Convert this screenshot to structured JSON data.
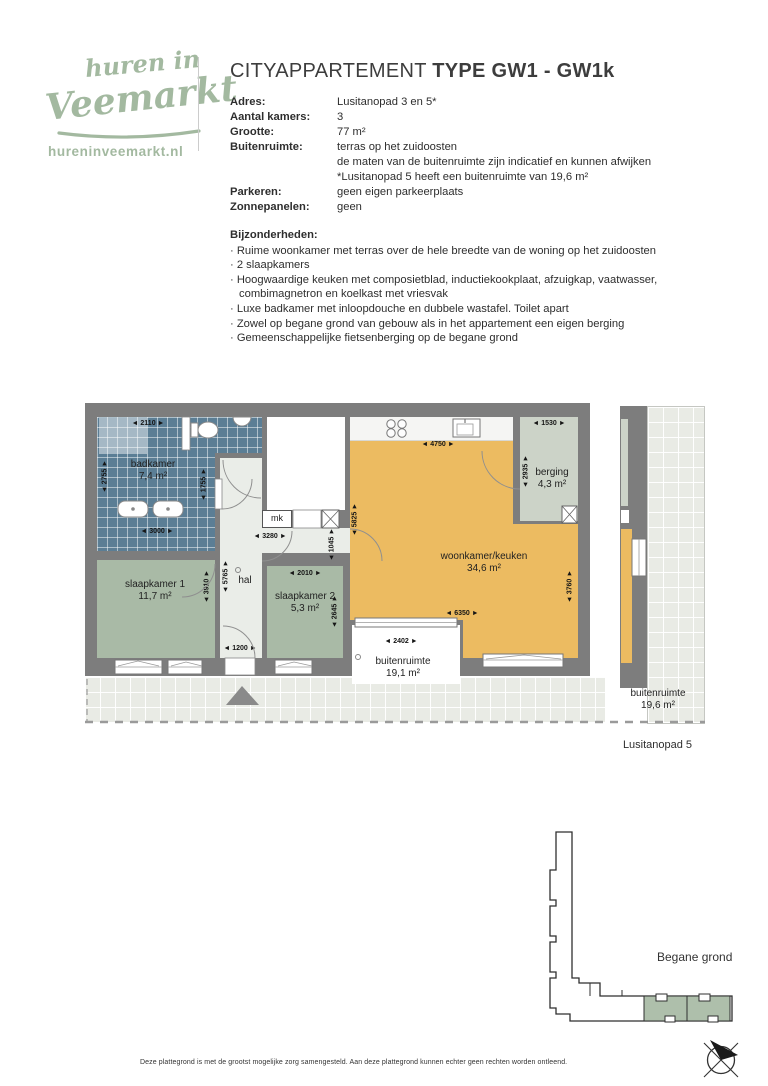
{
  "logo": {
    "script_line1": "huren in",
    "script_line2": "Veemarkt",
    "website": "hureninveemarkt.nl"
  },
  "header": {
    "title_regular": "CITYAPPARTEMENT",
    "title_bold": "TYPE GW1 - GW1k"
  },
  "details": {
    "rows": [
      {
        "label": "Adres:",
        "value": "Lusitanopad 3 en 5*"
      },
      {
        "label": "Aantal kamers:",
        "value": "3"
      },
      {
        "label": "Grootte:",
        "value": "77 m²"
      },
      {
        "label": "Buitenruimte:",
        "value": "terras op het zuidoosten"
      },
      {
        "label": "",
        "value": "de maten van de buitenruimte zijn indicatief en kunnen afwijken"
      },
      {
        "label": "",
        "value": "*Lusitanopad 5 heeft een buitenruimte van 19,6 m²"
      },
      {
        "label": "Parkeren:",
        "value": "geen eigen parkeerplaats"
      },
      {
        "label": "Zonnepanelen:",
        "value": "geen"
      }
    ]
  },
  "features": {
    "heading": "Bijzonderheden:",
    "items": [
      "Ruime woonkamer met terras over de hele breedte van de woning op het zuidoosten",
      "2 slaapkamers",
      "Hoogwaardige keuken met composietblad, inductiekookplaat, afzuigkap, vaatwasser, combimagnetron en koelkast met vriesvak",
      "Luxe badkamer met inloopdouche en dubbele wastafel. Toilet apart",
      "Zowel op begane grond van gebouw als in het appartement een eigen berging",
      "Gemeenschappelijke fietsenberging op de begane grond"
    ]
  },
  "plan": {
    "rooms": {
      "badkamer": {
        "name": "badkamer",
        "area": "7,4 m²"
      },
      "slaapkamer1": {
        "name": "slaapkamer 1",
        "area": "11,7 m²"
      },
      "slaapkamer2": {
        "name": "slaapkamer 2",
        "area": "5,3 m²"
      },
      "hal": {
        "name": "hal"
      },
      "mk": {
        "name": "mk"
      },
      "woonkamer": {
        "name": "woonkamer/keuken",
        "area": "34,6 m²"
      },
      "berging": {
        "name": "berging",
        "area": "4,3 m²"
      },
      "buitenruimte1": {
        "name": "buitenruimte",
        "area": "19,1 m²"
      },
      "buitenruimte2": {
        "name": "buitenruimte",
        "area": "19,6 m²"
      }
    },
    "dims": {
      "d2110": "◄ 2110 ►",
      "d2755": "◄ 2755 ►",
      "d1755": "◄ 1755 ►",
      "d3000": "◄ 3000 ►",
      "d5765": "◄ 5765 ►",
      "d3910": "◄ 3910 ►",
      "d1200": "◄ 1200 ►",
      "d3280": "◄ 3280 ►",
      "d1045": "◄ 1045 ►",
      "d2010": "◄ 2010 ►",
      "d2645": "◄ 2645 ►",
      "d4750": "◄ 4750 ►",
      "d5825": "◄ 5825 ►",
      "d6350": "◄ 6350 ►",
      "d3760": "◄ 3760 ►",
      "d1530": "◄ 1530 ►",
      "d2935": "◄ 2935 ►",
      "d2402": "◄ 2402 ►",
      "d3236": "◄ 3236 ►"
    }
  },
  "labels": {
    "lusitanopad": "Lusitanopad 5",
    "begane_grond": "Begane grond"
  },
  "footer": {
    "disclaimer": "Deze plattegrond is met de grootst mogelijke zorg samengesteld. Aan deze plattegrond kunnen echter geen rechten worden ontleend."
  },
  "colors": {
    "brand_green": "#a3b9a0",
    "wall_gray": "#7d7d7d",
    "room_green": "#a9baa6",
    "room_orange": "#ecbb61",
    "bath_tile_blue": "#5b7e95",
    "berging_green": "#ccd3c8"
  }
}
